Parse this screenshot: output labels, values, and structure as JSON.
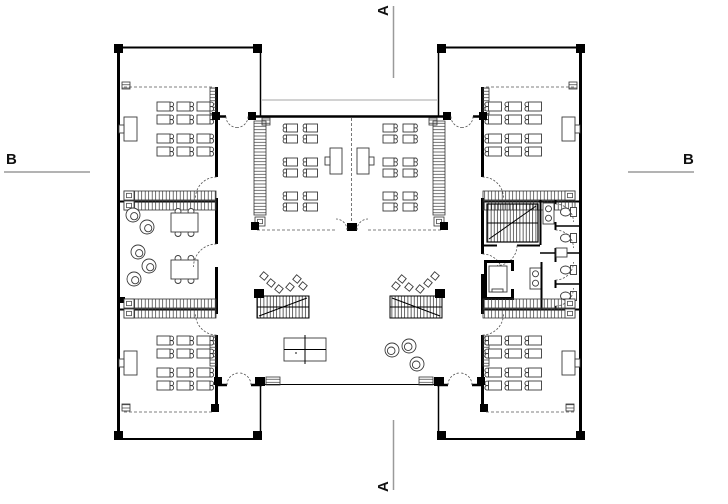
{
  "meta": {
    "drawing_type": "architectural floor plan (school building, ground floor)",
    "background": "#ffffff",
    "wall_color": "#000000",
    "furniture_color": "#3a3a3a",
    "section_line_color": "#9a9a9a"
  },
  "section_markers": {
    "top": "A",
    "bottom": "A",
    "left": "B",
    "right": "B"
  }
}
